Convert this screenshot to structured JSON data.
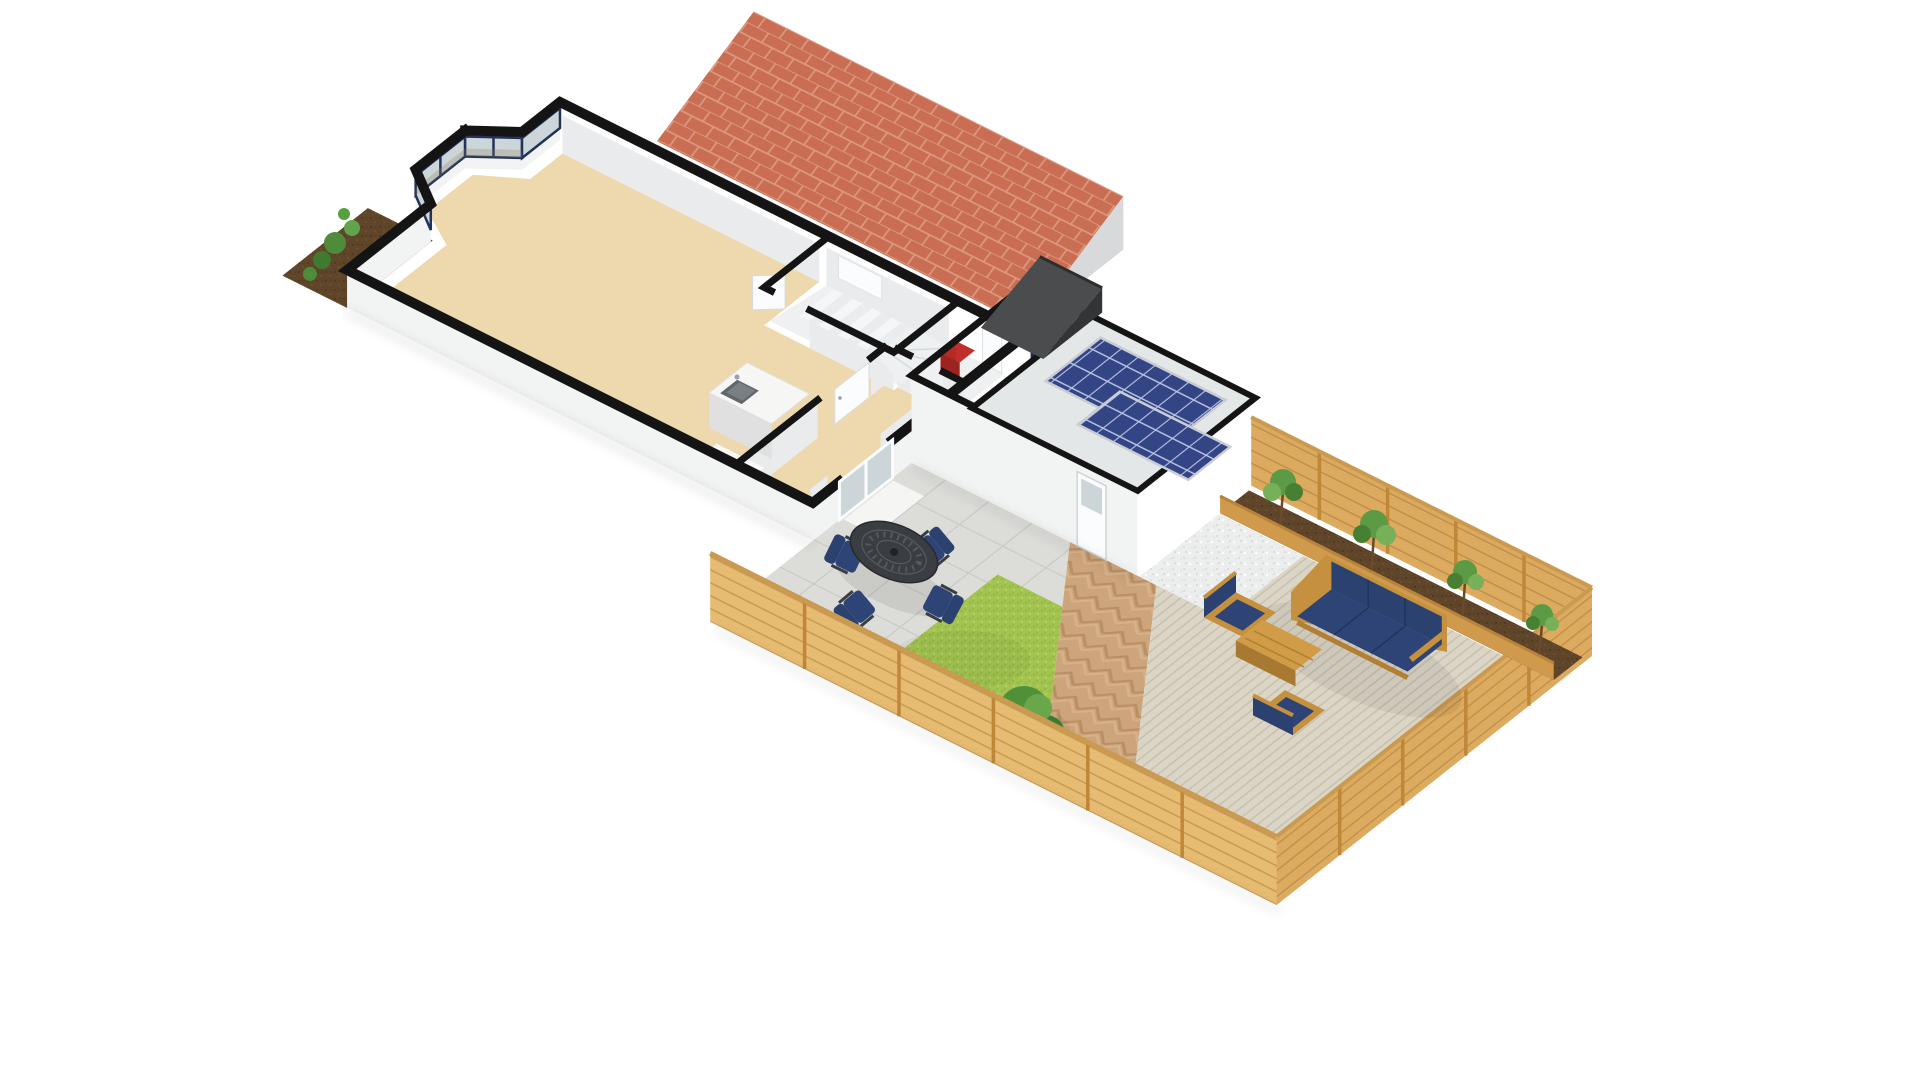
{
  "meta": {
    "title": "3D ground-floor plan render with rear garden",
    "view": "axonometric bird's-eye cutaway",
    "background": "#ffffff"
  },
  "colors": {
    "wall_cut": "#141414",
    "wall_exterior": "#f2f3f3",
    "wall_interior": "#e9ebec",
    "floor_tan": "#eed9ae",
    "floor_light": "#eef0f1",
    "stair_white": "#f4f6f7",
    "glass": "#ccd6d8",
    "glass_reflection": "#8a7a55",
    "window_frame": "#22325a",
    "door_white": "#fbfcfd",
    "island_white": "#f6f6f4",
    "island_side": "#e3e4e3",
    "sink_gray": "#61666a",
    "boiler_red": "#c0302a",
    "roof_red": "#c96e52",
    "roof_red_mortar": "#dfa189",
    "gable_light": "#d8d9db",
    "roof_dark": "#4b4c4e",
    "roof_dark_gable": "#333436",
    "garage_floor": "#dcdfe0",
    "garage_door_navy": "#1c2b4e",
    "garage_roof": "#e3e7e8",
    "solar_blue": "#344586",
    "solar_grid": "#b9c3e4",
    "solar_frame": "#c9ccd4",
    "patio": "#dcdcd8",
    "patio_joint": "#c8c8c5",
    "path_brick": "#cda57d",
    "path_brick_dark": "#b78a5e",
    "gravel": "#eceded",
    "deck": "#dbd5c6",
    "deck_line": "#c3bcab",
    "lawn": "#a3c452",
    "soil": "#5f4529",
    "fence_light": "#e6bb72",
    "fence_mid": "#dcab5f",
    "fence_post": "#c08738",
    "fence_cap": "#c99a50",
    "planter_rail": "#cf9a4c",
    "furniture_wood": "#c6913e",
    "furniture_wood_dark": "#b07f33",
    "cushion_navy": "#2e4476",
    "cushion_navy_dark": "#2b4170",
    "metal_dark": "#3a3e43",
    "tree_green": "#4f9038",
    "tree_green_dark": "#2f6b26",
    "tree_green_light": "#6aa74b",
    "shrub_green": "#4e8c3c",
    "trunk_brown": "#6b4a2a"
  },
  "scene": {
    "rooms": [
      {
        "name": "living-room",
        "floor": "tan",
        "features": [
          "bay-window",
          "kitchen-island-with-sink",
          "white-rug"
        ]
      },
      {
        "name": "stairwell",
        "features": [
          "winder-staircase",
          "party-wall-window",
          "open-door"
        ]
      },
      {
        "name": "hallway",
        "floor": "tan",
        "features": [
          "internal-door",
          "entrance-door"
        ]
      },
      {
        "name": "wc-store",
        "floor": "light",
        "features": [
          "red-boiler"
        ]
      },
      {
        "name": "garage",
        "features": [
          "navy-double-doors",
          "flat-roof",
          "solar-panel-arrays",
          "side-door"
        ]
      }
    ],
    "roofs": [
      {
        "name": "neighbor-roof",
        "material": "red-brick-tiles"
      },
      {
        "name": "porch-roof",
        "material": "dark-slate"
      }
    ],
    "garden": {
      "zones": [
        "patio-slabs",
        "lawn",
        "herringbone-path",
        "gravel-strip",
        "timber-deck",
        "raised-planter-bed",
        "front-soil-bed"
      ],
      "boundary": [
        "left-fence",
        "end-fence",
        "top-fence-with-planters"
      ]
    },
    "furniture": [
      {
        "name": "dining-set",
        "items": [
          "round-metal-table",
          "chair",
          "chair",
          "chair",
          "chair"
        ],
        "cushions": "navy"
      },
      {
        "name": "lounge-set",
        "items": [
          "three-seat-sofa",
          "armchair",
          "armchair",
          "coffee-table"
        ],
        "frame": "wood",
        "cushions": "navy"
      }
    ],
    "plants": [
      "front-shrubs",
      "patio-shrub",
      "planter-tree",
      "planter-tree",
      "planter-tree",
      "planter-tree",
      "lawn-tree"
    ],
    "solar": {
      "arrays": 2,
      "location": "garage-flat-roof"
    }
  }
}
